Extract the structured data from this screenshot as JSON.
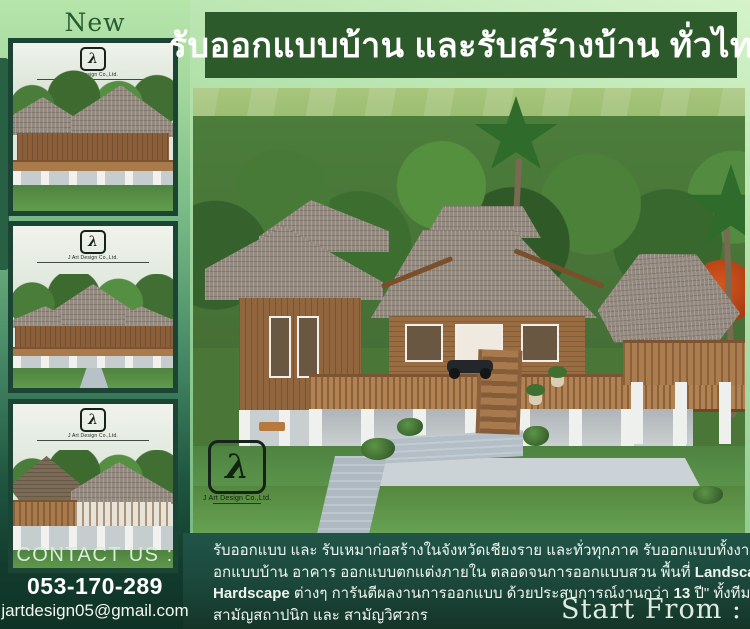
{
  "banner": {
    "title": "รับออกแบบบ้าน และรับสร้างบ้าน ทั่วไทย"
  },
  "sidebar": {
    "new_badge": "New",
    "contact": {
      "heading": "CONTACT US :",
      "phone": "053-170-289",
      "email": "jartdesign05@gmail.com"
    }
  },
  "logo": {
    "monogram": "λ",
    "company": "J Art Design Co.,Ltd."
  },
  "footer": {
    "description_lines": [
      [
        {
          "t": "รับออกแบบ  และ  รับเหมาก่อสร้างในจังหวัดเชียงราย  และทั่วทุกภาค  รับออกแบบทั้งงานอ",
          "b": false
        }
      ],
      [
        {
          "t": "อกแบบบ้าน  อาคาร  ออกแบบตกแต่งภายใน  ตลอดจนการออกแบบสวน  พื้นที่  ",
          "b": false
        },
        {
          "t": "Landscape",
          "b": true
        }
      ],
      [
        {
          "t": "Hardscape",
          "b": true
        },
        {
          "t": " ต่างๆ  การันตีผลงานการออกแบบ  ด้วยประสบการณ์งานกว่า ",
          "b": false
        },
        {
          "t": "13",
          "b": true
        },
        {
          "t": " ปี\" ทั้งทีมงาน",
          "b": false
        }
      ],
      [
        {
          "t": "สามัญสถาปนิก และ สามัญวิศวกร",
          "b": false
        }
      ]
    ],
    "start_from": "Start From :"
  },
  "colors": {
    "banner_green": "#2d5a2a",
    "footer_green": "#1c4a3d",
    "sidebar_dark_green": "#123c2d",
    "background_light_green": "#b4e2ab",
    "flame_tree_red": "#c2491a",
    "lawn_green": "#59914a"
  }
}
